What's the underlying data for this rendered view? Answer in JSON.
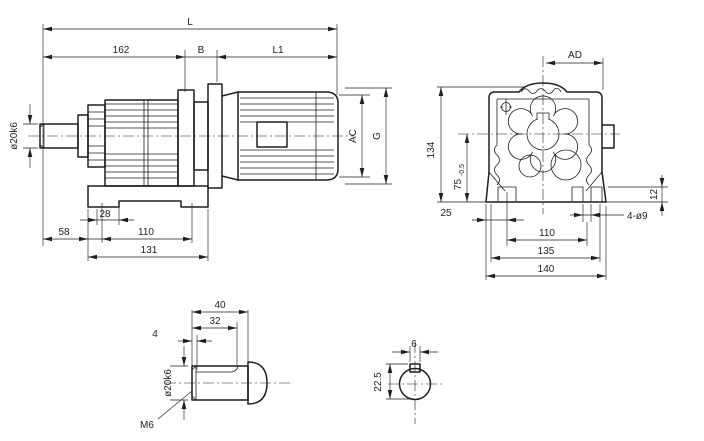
{
  "colors": {
    "ink": "#1f1f1f",
    "paper": "#ffffff"
  },
  "views": {
    "side_view": {
      "dims": {
        "L": "L",
        "seg162": "162",
        "B": "B",
        "L1": "L1",
        "shaft_dia": "ø20k6",
        "motor_dia_AC": "AC",
        "height_G": "G",
        "d28": "28",
        "d58": "58",
        "d110": "110",
        "d131": "131"
      }
    },
    "front_view": {
      "dims": {
        "AD": "AD",
        "d134": "134",
        "d75": "75",
        "d75_tol": "-0.5",
        "d25": "25",
        "d12": "12",
        "holes": "4-ø9",
        "d110": "110",
        "d135": "135",
        "d140": "140"
      }
    },
    "shaft_detail": {
      "dims": {
        "d40": "40",
        "d32": "32",
        "d4": "4",
        "shaft_dia": "ø20k6",
        "tapped_hole": "M6"
      }
    },
    "key_section": {
      "dims": {
        "d6": "6",
        "d22_5": "22.5"
      }
    }
  }
}
